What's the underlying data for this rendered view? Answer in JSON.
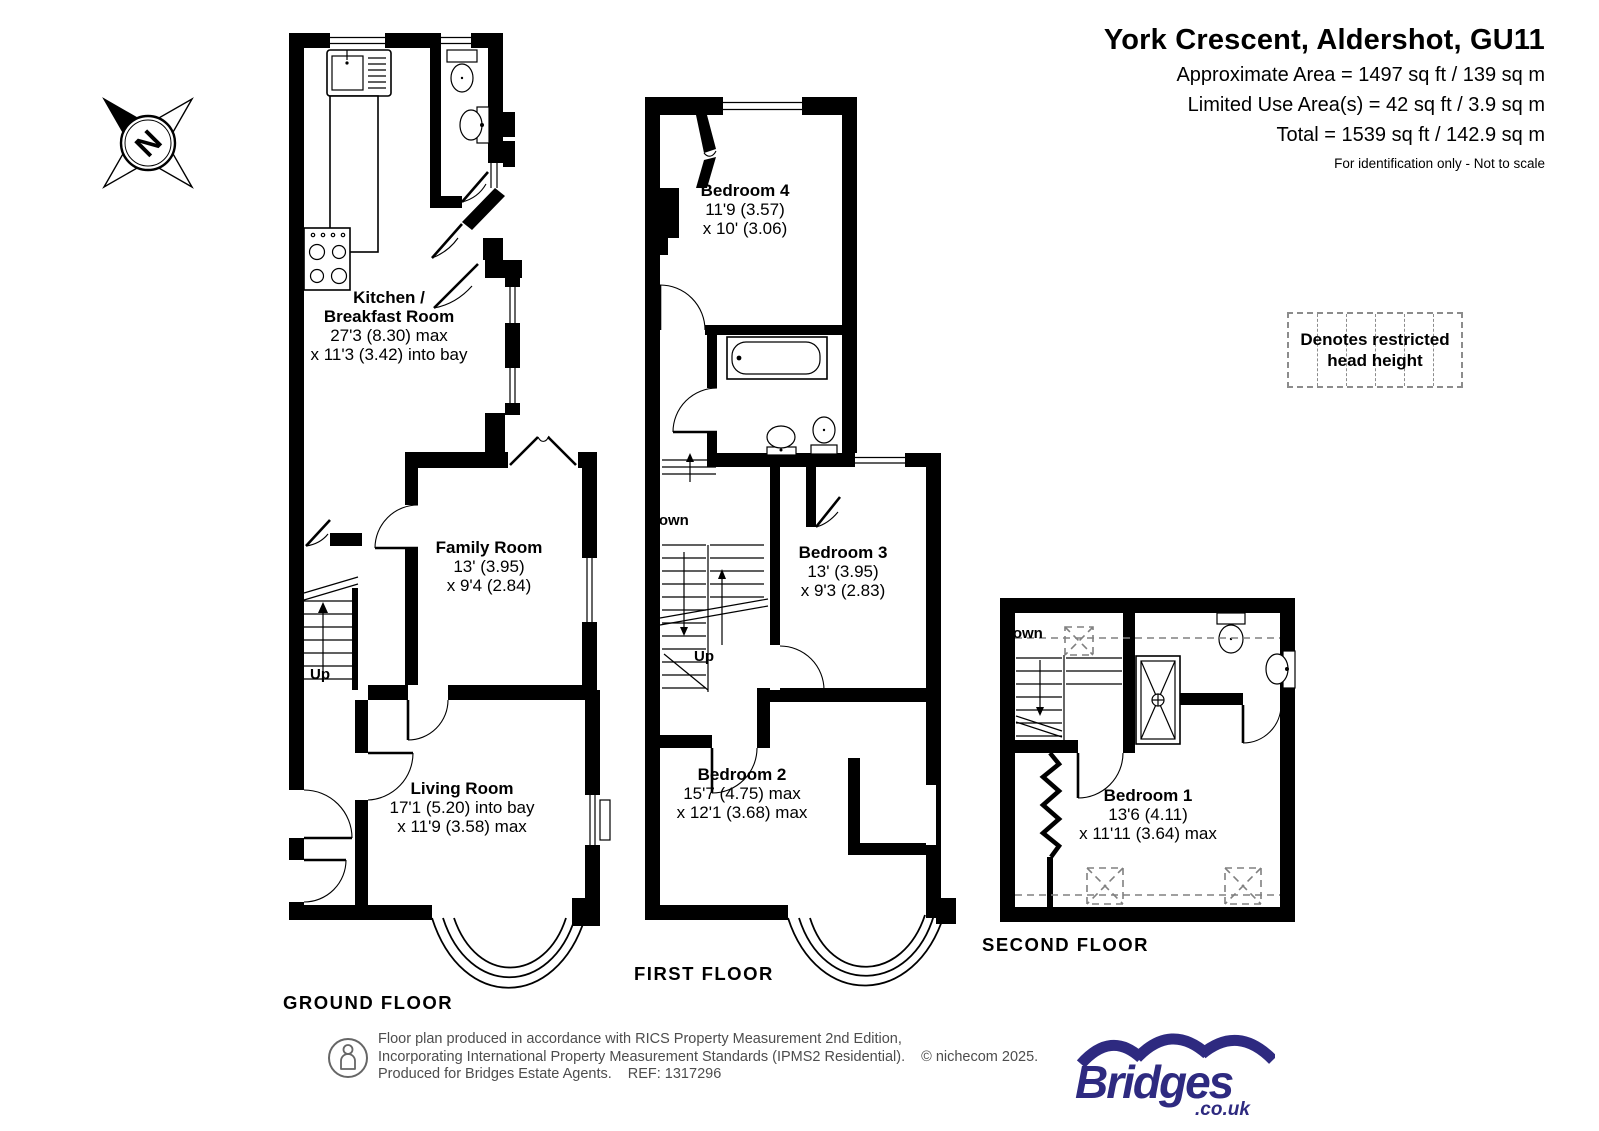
{
  "header": {
    "title": "York Crescent, Aldershot, GU11",
    "line1": "Approximate Area = 1497 sq ft / 139 sq m",
    "line2": "Limited Use Area(s) = 42 sq ft / 3.9 sq m",
    "line3": "Total = 1539 sq ft / 142.9 sq m",
    "note": "For identification only - Not to scale"
  },
  "compass": {
    "letter": "N"
  },
  "legend": {
    "line1": "Denotes restricted",
    "line2": "head height"
  },
  "floors": {
    "ground": {
      "label": "GROUND FLOOR",
      "rooms": {
        "kitchen": {
          "name": "Kitchen /",
          "name2": "Breakfast Room",
          "dim1": "27'3 (8.30) max",
          "dim2": "x 11'3 (3.42) into bay"
        },
        "family": {
          "name": "Family Room",
          "dim1": "13' (3.95)",
          "dim2": "x 9'4 (2.84)"
        },
        "living": {
          "name": "Living Room",
          "dim1": "17'1 (5.20) into bay",
          "dim2": "x 11'9 (3.58) max"
        }
      },
      "stairs": {
        "up": "Up"
      }
    },
    "first": {
      "label": "FIRST FLOOR",
      "rooms": {
        "bedroom4": {
          "name": "Bedroom 4",
          "dim1": "11'9 (3.57)",
          "dim2": "x 10' (3.06)"
        },
        "bedroom3": {
          "name": "Bedroom 3",
          "dim1": "13' (3.95)",
          "dim2": "x 9'3 (2.83)"
        },
        "bedroom2": {
          "name": "Bedroom 2",
          "dim1": "15'7 (4.75) max",
          "dim2": "x 12'1 (3.68) max"
        }
      },
      "stairs": {
        "down": "Down",
        "up": "Up"
      }
    },
    "second": {
      "label": "SECOND FLOOR",
      "rooms": {
        "bedroom1": {
          "name": "Bedroom 1",
          "dim1": "13'6 (4.11)",
          "dim2": "x 11'11 (3.64) max"
        }
      },
      "stairs": {
        "down": "Down"
      }
    }
  },
  "footer": {
    "line1": "Floor plan produced in accordance with RICS Property Measurement 2nd Edition,",
    "line2": "Incorporating International Property Measurement Standards (IPMS2 Residential).",
    "copyright": "© nichecom 2025.",
    "line3": "Produced for Bridges Estate Agents.",
    "ref": "REF: 1317296",
    "logo": {
      "name": "Bridges",
      "suffix": ".co.uk"
    }
  },
  "colors": {
    "brand": "#2e2a80",
    "muted": "#4d4d4d",
    "dash": "#8c8c8c"
  }
}
